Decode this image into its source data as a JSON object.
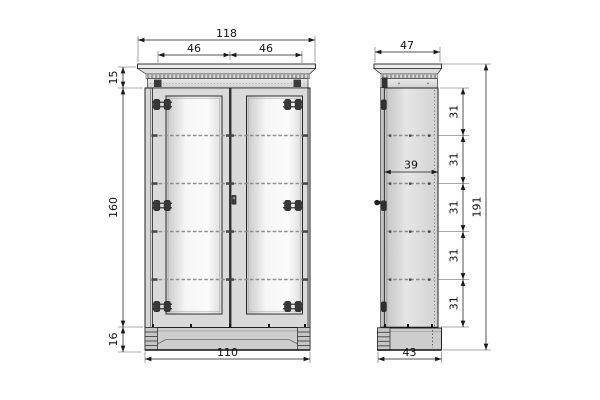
{
  "drawing": {
    "type": "furniture-technical-drawing",
    "views": [
      "front-elevation",
      "side-elevation"
    ],
    "units_implied": "cm",
    "colors": {
      "background": "#ffffff",
      "line": "#1a1a1a",
      "panel_light": "#f6f6f6",
      "panel_mid": "#d7d7d7",
      "plinth": "#cdcdcd",
      "hardware": "#333333"
    }
  },
  "front_view": {
    "dims": {
      "overall_width": "118",
      "left_door_width": "46",
      "right_door_width": "46",
      "cornice_height": "15",
      "body_height": "160",
      "plinth_height": "16",
      "plinth_width": "110"
    },
    "features": [
      "crown-cornice",
      "dentil-molding",
      "two-panel-doors",
      "three-hinges-per-door",
      "keyhole",
      "arched-plinth",
      "four-shelf-hidden-lines"
    ]
  },
  "side_view": {
    "dims": {
      "cornice_depth": "47",
      "interior_depth": "39",
      "shelf_spacings": [
        "31",
        "31",
        "31",
        "31",
        "31"
      ],
      "overall_height": "191",
      "plinth_depth": "43"
    },
    "features": [
      "crown-cornice-profile",
      "door-knob-profile",
      "hinge-knuckles",
      "hidden-shelf-lines",
      "plinth-foot"
    ]
  }
}
